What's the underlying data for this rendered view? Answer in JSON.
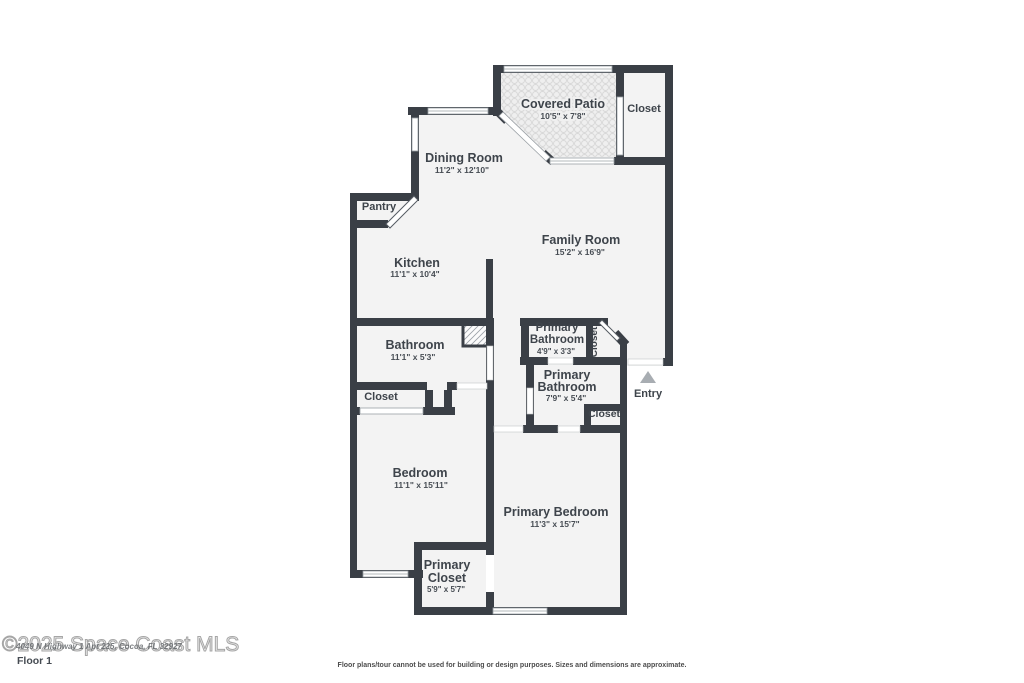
{
  "colors": {
    "wall": "#3a3f46",
    "room_fill": "#f3f3f3",
    "patio_tile_line": "#d8d8d8",
    "entry_arrow": "#a8adb2",
    "label_text": "#3e444b"
  },
  "floorplan": {
    "covered_patio": {
      "name": "Covered Patio",
      "dims": "10'5\" x 7'8\""
    },
    "closet_top_right": {
      "name": "Closet"
    },
    "dining_room": {
      "name": "Dining Room",
      "dims": "11'2\" x 12'10\""
    },
    "pantry": {
      "name": "Pantry"
    },
    "family_room": {
      "name": "Family Room",
      "dims": "15'2\" x 16'9\""
    },
    "kitchen": {
      "name": "Kitchen",
      "dims": "11'1\" x 10'4\""
    },
    "bathroom": {
      "name": "Bathroom",
      "dims": "11'1\" x 5'3\""
    },
    "primary_bathroom_small": {
      "line1": "Primary",
      "line2": "Bathroom",
      "dims": "4'9\" x 3'3\""
    },
    "hall_closet": {
      "name": "Closet"
    },
    "primary_bathroom": {
      "line1": "Primary",
      "line2": "Bathroom",
      "dims": "7'9\" x 5'4\""
    },
    "entry": {
      "name": "Entry"
    },
    "suite_closet": {
      "name": "Closet"
    },
    "bedroom_closet": {
      "name": "Closet"
    },
    "bedroom": {
      "name": "Bedroom",
      "dims": "11'1\" x 15'11\""
    },
    "primary_bedroom": {
      "name": "Primary Bedroom",
      "dims": "11'3\" x 15'7\""
    },
    "primary_closet": {
      "line1": "Primary",
      "line2": "Closet",
      "dims": "5'9\" x 5'7\""
    }
  },
  "footer": {
    "floor_label": "Floor 1",
    "disclaimer": "Floor plans/tour cannot be used for building or design purposes. Sizes and dimensions are approximate."
  },
  "watermark": {
    "copyright": "©2025 Space Coast MLS",
    "address": "4049 N Highway 1 Apt 225, Cocoa, FL 32927"
  }
}
